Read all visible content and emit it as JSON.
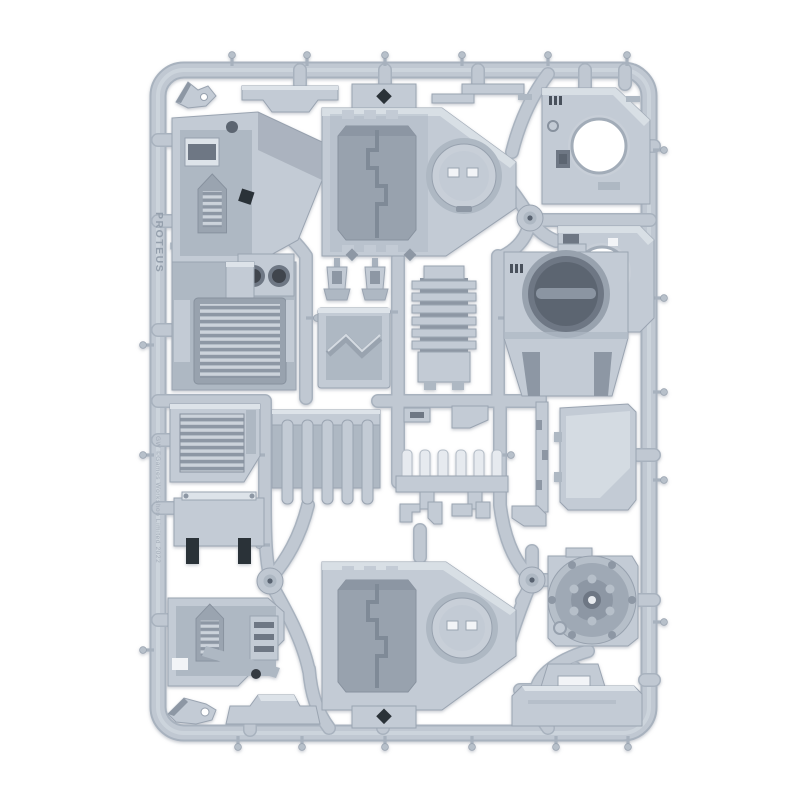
{
  "image": {
    "subject": "Grey plastic model kit sprue (tank accessory frame) photographed on a white background",
    "background_color": "#ffffff"
  },
  "sprue": {
    "frame_text_primary": "PROTEUS",
    "frame_text_copyright": "GW ©Games Workshop Limited 2022",
    "colors": {
      "plastic_base": "#c3cbd5",
      "plastic_light": "#dde3e9",
      "plastic_mid": "#aeb8c3",
      "plastic_shadow": "#8d97a4",
      "recess_deep": "#5c6571",
      "detail_black": "#2c3037",
      "hole_white": "#ffffff"
    },
    "parts": [
      {
        "name": "Angled wing bracket"
      },
      {
        "name": "Towing hook clip"
      },
      {
        "name": "Side armour panel with intake vent"
      },
      {
        "name": "Hull roof section - octagonal door frame and round crew hatch"
      },
      {
        "name": "Hull side panel with circular hatch opening"
      },
      {
        "name": "Hull side panel with circular hatch opening"
      },
      {
        "name": "Rear bulkhead with circular recess and grab handle"
      },
      {
        "name": "Finned engine radiator block"
      },
      {
        "name": "Engine deck with louvred grille and twin exhausts"
      },
      {
        "name": "Searchlight housing"
      },
      {
        "name": "Searchlight housing"
      },
      {
        "name": "Access hatch with chevron tread"
      },
      {
        "name": "Louvred vent hatch"
      },
      {
        "name": "Ribbed suspension panel"
      },
      {
        "name": "Periscope vision-block rail"
      },
      {
        "name": "Narrow hull side panel"
      },
      {
        "name": "Stepped mounting strip"
      },
      {
        "name": "Top plate with slotted feet"
      },
      {
        "name": "Side armour panel with intake vent"
      },
      {
        "name": "Low fender section"
      },
      {
        "name": "Hull roof section - octagonal door frame and round crew hatch"
      },
      {
        "name": "Drive wheel hub with bolted rim"
      },
      {
        "name": "Rear access panel with handle recess"
      },
      {
        "name": "Towing hook clip"
      }
    ]
  }
}
